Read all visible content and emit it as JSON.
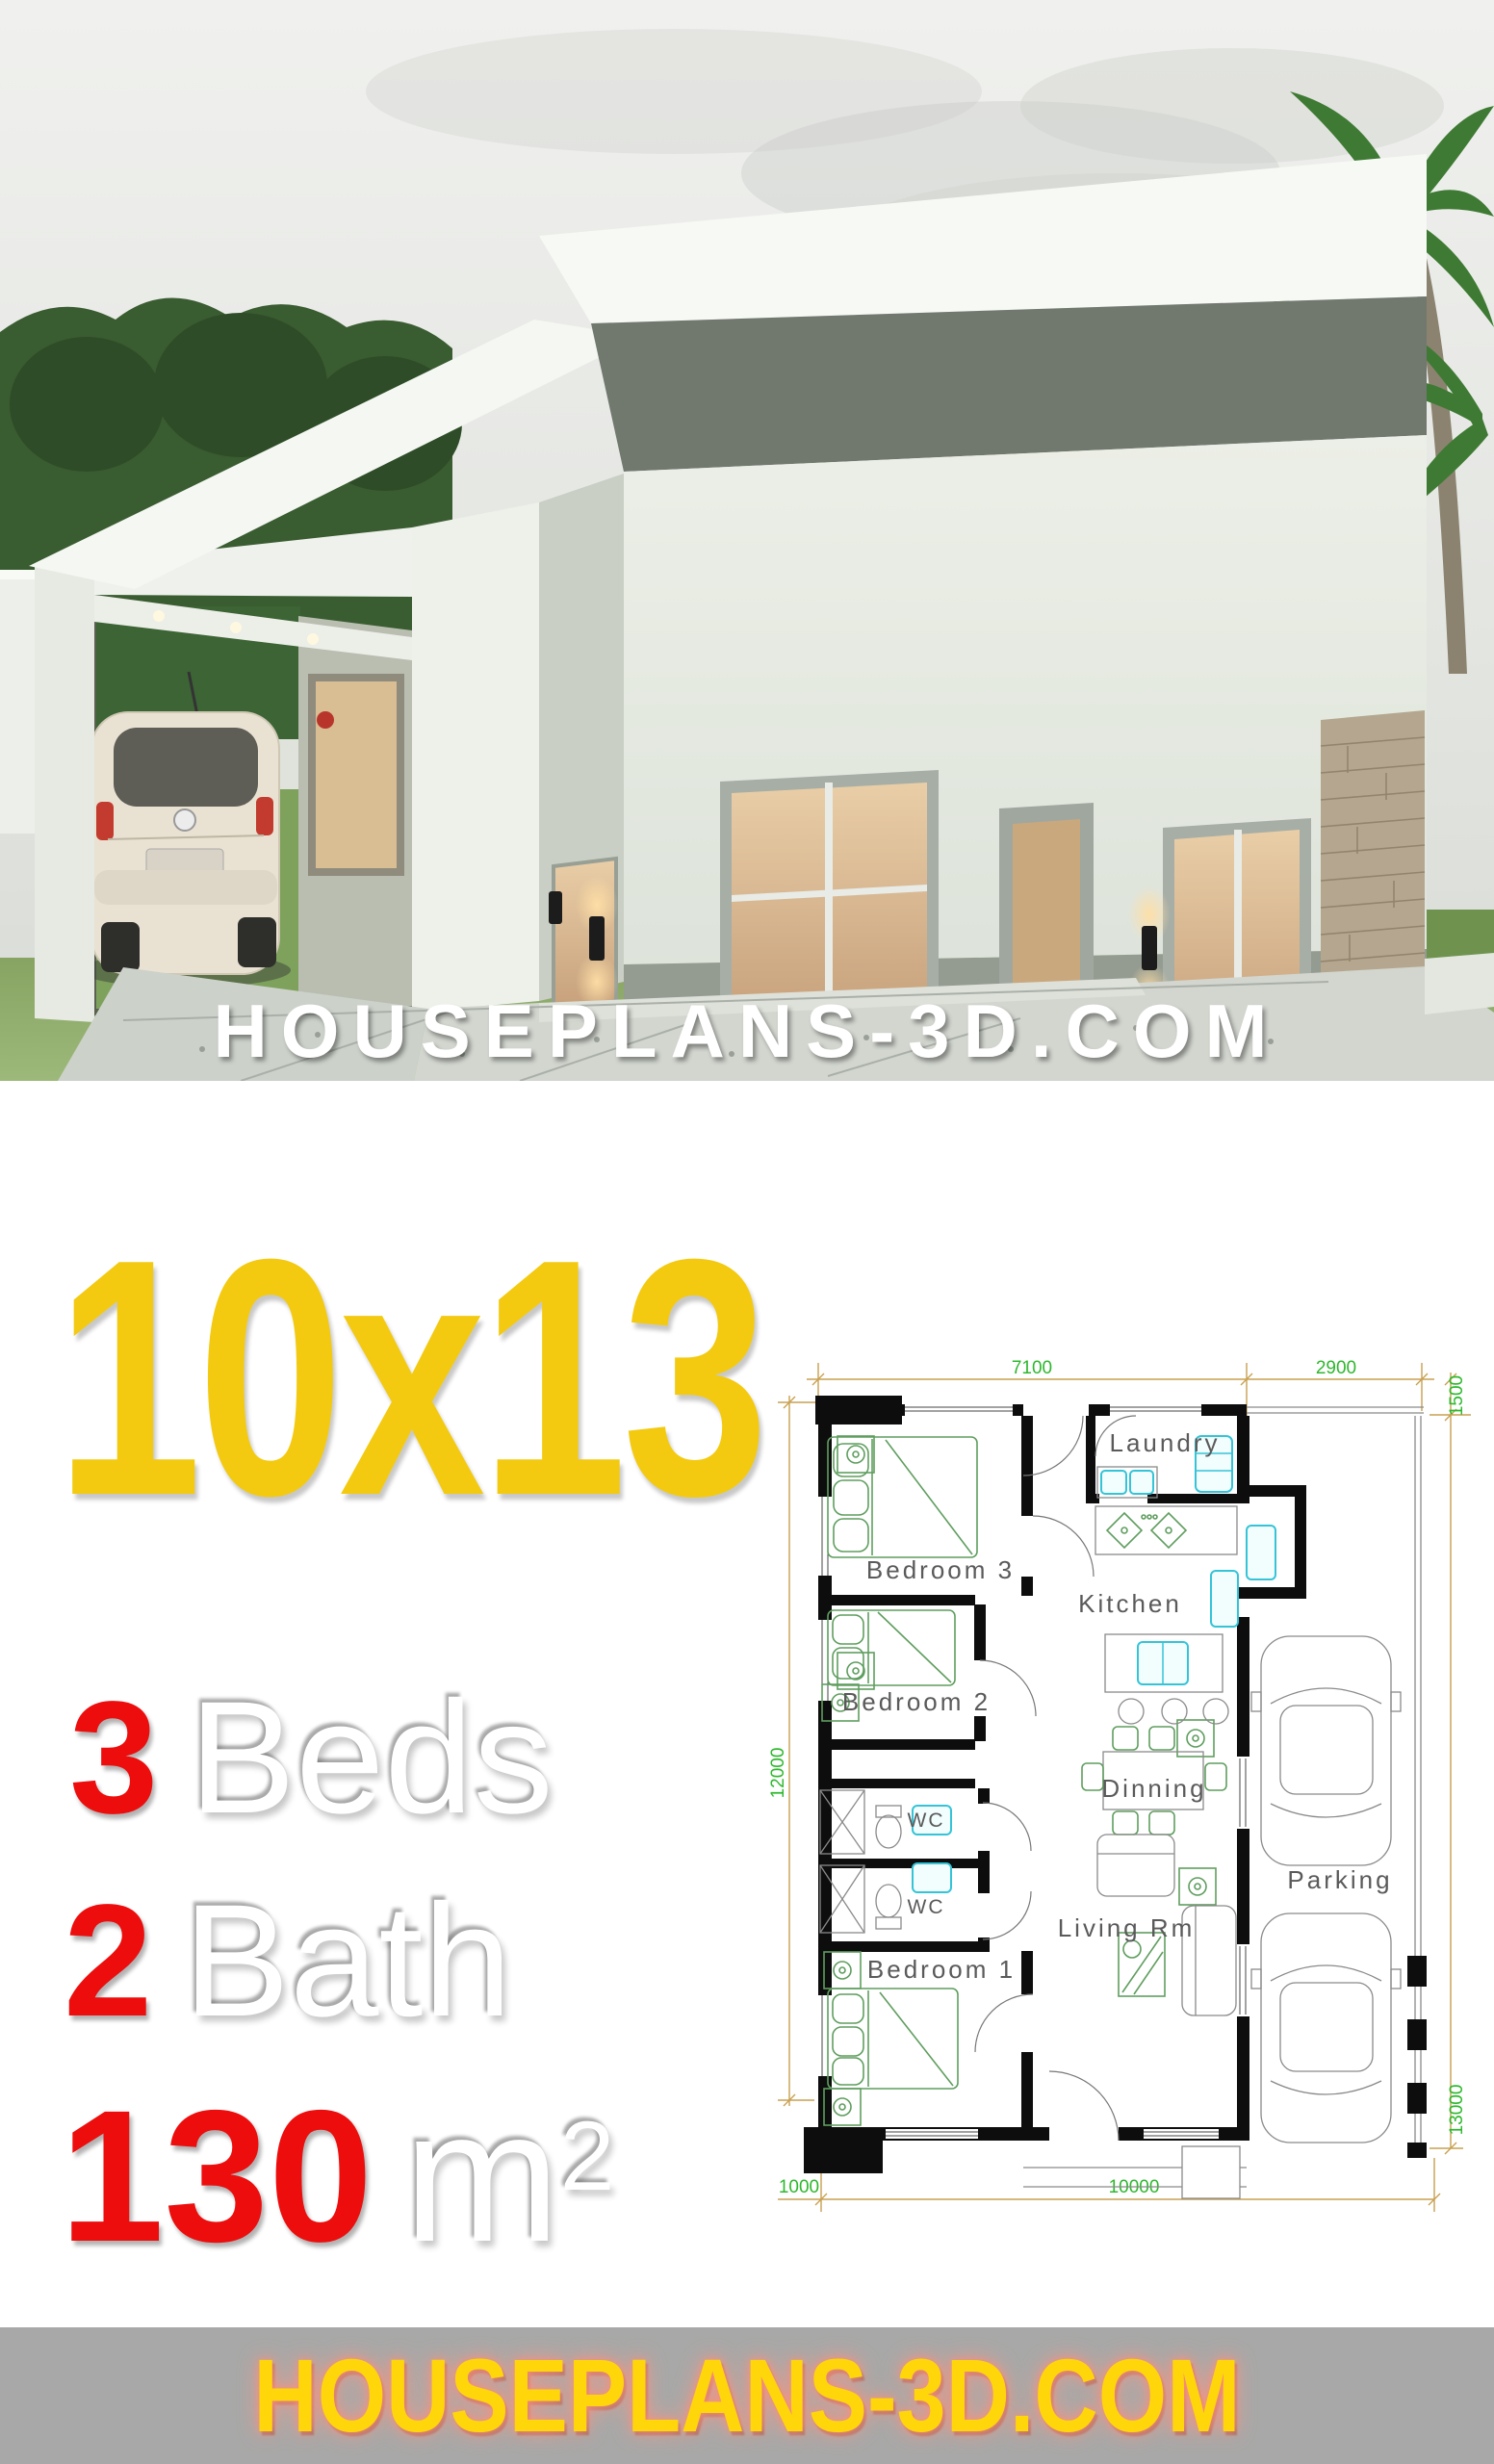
{
  "hero": {
    "watermark": "HOUSEPLANS-3D.COM"
  },
  "specs": {
    "size_label": "10x13",
    "beds": {
      "value": "3",
      "label": "Beds"
    },
    "bath": {
      "value": "2",
      "label": "Bath"
    },
    "area": {
      "value": "130",
      "unit": "m",
      "superscript": "2"
    },
    "colors": {
      "size_yellow": "#f3ca10",
      "accent_red": "#ed0d0d"
    }
  },
  "floor_plan": {
    "labels": {
      "laundry": "Laundry",
      "kitchen": "Kitchen",
      "bedroom3": "Bedroom 3",
      "bedroom2": "Bedroom 2",
      "bedroom1": "Bedroom 1",
      "wc1": "WC",
      "wc2": "WC",
      "dinning": "Dinning",
      "living": "Living Rm",
      "parking": "Parking"
    },
    "dimensions": {
      "top_main": "7100",
      "top_parking": "2900",
      "right_setback": "1500",
      "left_depth": "12000",
      "right_depth": "13000",
      "bottom_offset": "1000",
      "bottom_main": "10000"
    },
    "colors": {
      "wall": "#0d0d0d",
      "dimension_line": "#c8a050",
      "dimension_text": "#2db82d",
      "furniture_green": "#5f9e5f",
      "fixture_cyan": "#35c4d7",
      "label_text": "#5a5a5a"
    }
  },
  "footer": {
    "brand": "HOUSEPLANS-3D.COM",
    "background": "#a8a8a8",
    "text_color": "#ffd60a"
  }
}
